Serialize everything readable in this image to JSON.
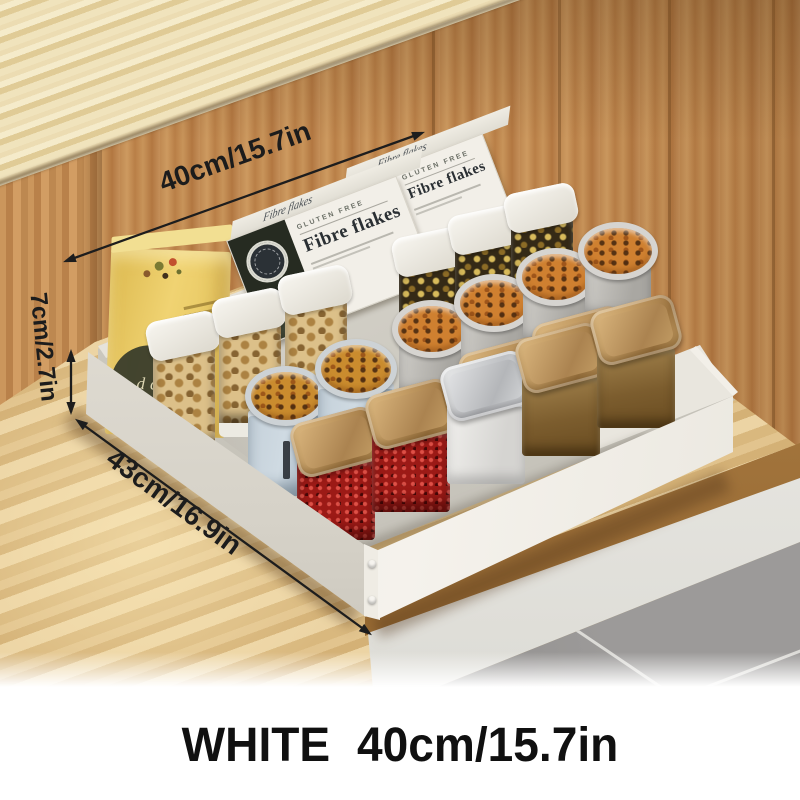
{
  "annotations": {
    "width_label": "40cm/15.7in",
    "height_label": "7cm/2.7in",
    "depth_label": "43cm/16.9in"
  },
  "caption": {
    "color_name": "WHITE",
    "size": "40cm/15.7in"
  },
  "products": {
    "cereal_box": {
      "tagline": "GLUTEN FREE",
      "name": "Fibre flakes"
    },
    "cracker_box": {
      "letters": "dc"
    }
  },
  "colors": {
    "drawer_white": "#f0ede6",
    "cabinet_wood": "#c08a52",
    "countertop_wood": "#ecdcb2",
    "floor_wood": "#dfc08b",
    "tile_gray": "#9b999a",
    "lid_gold": "#c59e66",
    "lid_silver": "#d6d4d0",
    "chili_red": "#9c1a16",
    "spice_brown": "#8a6a3a",
    "turmeric_orange": "#cf8030",
    "canister_blue": "#b7c4cf",
    "cracker_box_yellow": "#eccf67",
    "annotation_ink": "#1d1d1d"
  }
}
